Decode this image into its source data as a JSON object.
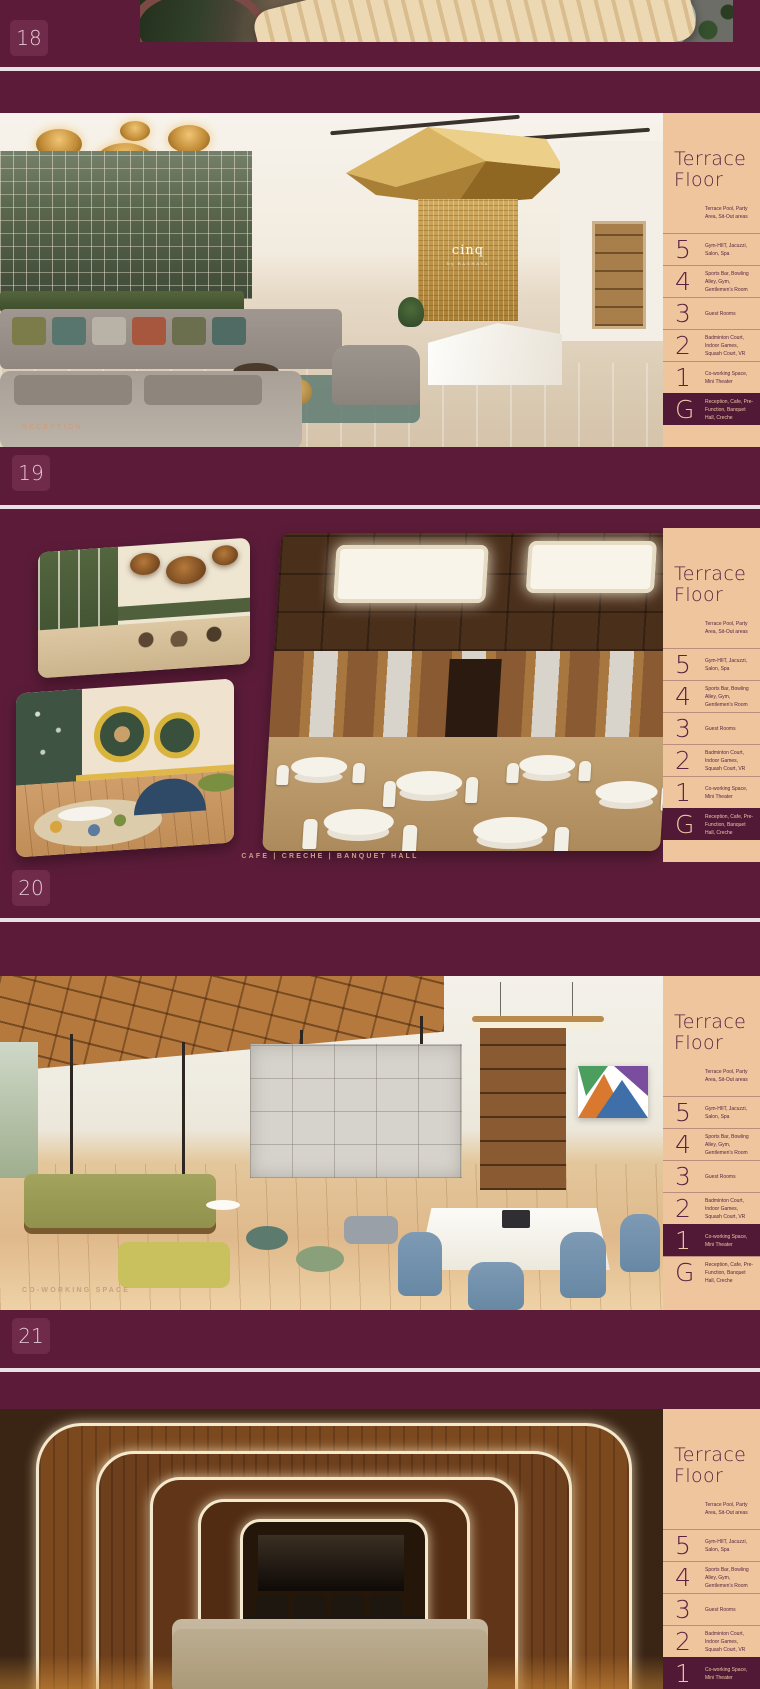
{
  "colors": {
    "background": "#5c1c39",
    "separator": "#e9e1e5",
    "sidebar_bg": "#eec59d",
    "sidebar_text": "#5e2242",
    "highlight_bg": "#511935",
    "highlight_text": "#ecc9a4",
    "caption": "#c9a085",
    "page_tile_bg": "#6f2b49",
    "page_tile_text": "#e3ccd6"
  },
  "logo": {
    "brand": "cinq",
    "byline": "by RAGHAVA"
  },
  "sidebar": {
    "title_line1": "Terrace",
    "title_line2": "Floor",
    "terrace_desc": "Terrace Pool, Party Area, Sit-Out areas",
    "floors": [
      {
        "label": "5",
        "desc": "Gym-HIIT, Jacuzzi, Salon, Spa"
      },
      {
        "label": "4",
        "desc": "Sports Bar, Bowling Alley, Gym, Gentlemen's Room"
      },
      {
        "label": "3",
        "desc": "Guest Rooms"
      },
      {
        "label": "2",
        "desc": "Badminton Court, Indoor Games, Squash Court, VR"
      },
      {
        "label": "1",
        "desc": "Co-working Space, Mini Theater"
      },
      {
        "label": "G",
        "desc": "Reception, Cafe, Pre-Function, Banquet Hall, Creche"
      }
    ]
  },
  "slides": [
    {
      "page": "18"
    },
    {
      "page": "19",
      "caption": "RECEPTION",
      "highlight": "G"
    },
    {
      "page": "20",
      "caption": "CAFE | CRECHE | BANQUET HALL",
      "highlight": "G"
    },
    {
      "page": "21",
      "caption": "CO-WORKING SPACE",
      "highlight": "1"
    },
    {
      "page": "",
      "highlight": "1"
    }
  ]
}
